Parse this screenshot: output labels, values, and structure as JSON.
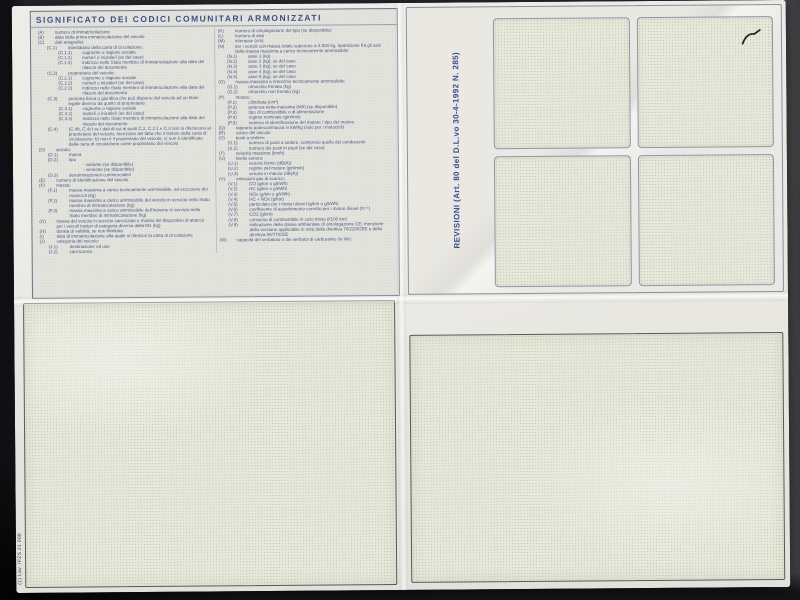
{
  "document": {
    "title": "SIGNIFICATO DEI CODICI COMUNITARI ARMONIZZATI",
    "revisions_label": "REVISIONI (Art. 80 del D.L.vo 30-4-1992 N. 285)",
    "print_code": "(1) Lav. IPZS 21 008",
    "colors": {
      "photo_background": "#232427",
      "paper": "#e8e7e2",
      "ink_blue": "#4a557e",
      "box_fill": "#e6e8db",
      "box_dot": "#7d915f",
      "border_gray": "#8a8f9c",
      "border_dark": "#565b52"
    },
    "codes_left": [
      {
        "c": "(A)",
        "t": "numero di immatricolazione",
        "lvl": 0
      },
      {
        "c": "(B)",
        "t": "data della prima immatricolazione del veicolo",
        "lvl": 0
      },
      {
        "c": "(C)",
        "t": "dati anagrafici:",
        "lvl": 0
      },
      {
        "c": "(C.1)",
        "t": "intestatario della carta di circolazione:",
        "lvl": 1
      },
      {
        "c": "(C.1.1)",
        "t": "cognome o ragione sociale",
        "lvl": 2
      },
      {
        "c": "(C.1.2)",
        "t": "nome/i o iniziale/i (se del caso)",
        "lvl": 2
      },
      {
        "c": "(C.1.3)",
        "t": "indirizzo nello Stato membro di immatricolazione alla data del rilascio del documento",
        "lvl": 2
      },
      {
        "c": "(C.2)",
        "t": "proprietario del veicolo:",
        "lvl": 1
      },
      {
        "c": "(C.2.1)",
        "t": "cognome o ragione sociale",
        "lvl": 2
      },
      {
        "c": "(C.2.2)",
        "t": "nome/i o iniziale/i (se del caso)",
        "lvl": 2
      },
      {
        "c": "(C.2.3)",
        "t": "indirizzo nello Stato membro di immatricolazione alla data del rilascio del documento",
        "lvl": 2
      },
      {
        "c": "(C.3)",
        "t": "persona fisica o giuridica che può disporre del veicolo ad un titolo legale diverso da quello di proprietario:",
        "lvl": 1
      },
      {
        "c": "(C.3.1)",
        "t": "cognome o ragione sociale",
        "lvl": 2
      },
      {
        "c": "(C.3.2)",
        "t": "nome/i o iniziale/i (se del caso)",
        "lvl": 2
      },
      {
        "c": "(C.3.3)",
        "t": "indirizzo nello Stato membro di immatricolazione alla data del rilascio del documento",
        "lvl": 2
      },
      {
        "c": "(C.4)",
        "t": "(C.4b, C.4c) se i dati di cui ai punti C.2, C.2.1 e C.3 non si riferiscono al proprietario del veicolo, menzione del fatto che il titolare della carta di circolazione: b) non è il proprietario del veicolo; c) non è identificato dalla carta di circolazione come proprietario del veicolo",
        "lvl": 1
      },
      {
        "c": "(D)",
        "t": "veicolo:",
        "lvl": 0
      },
      {
        "c": "(D.1)",
        "t": "marca",
        "lvl": 1
      },
      {
        "c": "(D.2)",
        "t": "tipo",
        "lvl": 1
      },
      {
        "c": "",
        "t": "- variante (se disponibile)",
        "lvl": 2
      },
      {
        "c": "",
        "t": "- versione (se disponibile)",
        "lvl": 2
      },
      {
        "c": "(D.3)",
        "t": "denominazione/i commerciale/i",
        "lvl": 1
      },
      {
        "c": "(E)",
        "t": "numero di identificazione del veicolo",
        "lvl": 0
      },
      {
        "c": "(F)",
        "t": "massa:",
        "lvl": 0
      },
      {
        "c": "(F.1)",
        "t": "massa massima a carico tecnicamente ammissibile, ad eccezione dei motocicli (kg)",
        "lvl": 1
      },
      {
        "c": "(F.2)",
        "t": "massa massima a carico ammissibile del veicolo in servizio nello Stato membro di immatricolazione (kg)",
        "lvl": 1
      },
      {
        "c": "(F.3)",
        "t": "massa massima a carico ammissibile dell'insieme in servizio nello Stato membro di immatricolazione (kg)",
        "lvl": 1
      },
      {
        "c": "(G)",
        "t": "massa del veicolo in servizio carrozzato e munito del dispositivo di attacco per i veicoli trattori di categoria diversa dalla M1 (kg)",
        "lvl": 0
      },
      {
        "c": "(H)",
        "t": "durata di validità, se non illimitata",
        "lvl": 0
      },
      {
        "c": "(I)",
        "t": "data di immatricolazione alla quale si riferisce la carta di circolazione",
        "lvl": 0
      },
      {
        "c": "(J)",
        "t": "categoria del veicolo:",
        "lvl": 0
      },
      {
        "c": "(J.1)",
        "t": "destinazione ed uso",
        "lvl": 1
      },
      {
        "c": "(J.2)",
        "t": "carrozzeria",
        "lvl": 1
      }
    ],
    "codes_right": [
      {
        "c": "(K)",
        "t": "numero di omologazione del tipo (se disponibile)",
        "lvl": 0
      },
      {
        "c": "(L)",
        "t": "numero di assi",
        "lvl": 0
      },
      {
        "c": "(M)",
        "t": "interasse (cm)",
        "lvl": 0
      },
      {
        "c": "(N)",
        "t": "per i veicoli con massa totale superiore a 3.500 kg, ripartizione fra gli assi della massa massima a carico tecnicamente ammissibile:",
        "lvl": 0
      },
      {
        "c": "(N.1)",
        "t": "asse 1 (kg)",
        "lvl": 1
      },
      {
        "c": "(N.2)",
        "t": "asse 2 (kg), se del caso",
        "lvl": 1
      },
      {
        "c": "(N.3)",
        "t": "asse 3 (kg), se del caso",
        "lvl": 1
      },
      {
        "c": "(N.4)",
        "t": "asse 4 (kg), se del caso",
        "lvl": 1
      },
      {
        "c": "(N.5)",
        "t": "asse 5 (kg), se del caso",
        "lvl": 1
      },
      {
        "c": "(O)",
        "t": "massa massima a rimorchio tecnicamente ammissibile:",
        "lvl": 0
      },
      {
        "c": "(O.1)",
        "t": "rimorchio frenato (kg)",
        "lvl": 1
      },
      {
        "c": "(O.2)",
        "t": "rimorchio non frenato (kg)",
        "lvl": 1
      },
      {
        "c": "(P)",
        "t": "motore:",
        "lvl": 0
      },
      {
        "c": "(P.1)",
        "t": "cilindrata (cm³)",
        "lvl": 1
      },
      {
        "c": "(P.2)",
        "t": "potenza netta massima (kW) (se disponibile)",
        "lvl": 1
      },
      {
        "c": "(P.3)",
        "t": "tipo di combustibile o di alimentazione",
        "lvl": 1
      },
      {
        "c": "(P.4)",
        "t": "regime nominale (giri/min)",
        "lvl": 1
      },
      {
        "c": "(P.5)",
        "t": "numero di identificazione del motore / tipo del motore",
        "lvl": 1
      },
      {
        "c": "(Q)",
        "t": "rapporto potenza/massa in kW/kg (solo per i motocicli)",
        "lvl": 0
      },
      {
        "c": "(R)",
        "t": "colore del veicolo",
        "lvl": 0
      },
      {
        "c": "(S)",
        "t": "posti a sedere:",
        "lvl": 0
      },
      {
        "c": "(S.1)",
        "t": "numero di posti a sedere, compreso quello del conducente",
        "lvl": 1
      },
      {
        "c": "(S.2)",
        "t": "numero dei posti in piedi (se del caso)",
        "lvl": 1
      },
      {
        "c": "(T)",
        "t": "velocità massima (km/h)",
        "lvl": 0
      },
      {
        "c": "(U)",
        "t": "livello sonoro:",
        "lvl": 0
      },
      {
        "c": "(U.1)",
        "t": "veicolo fermo (dB(A))",
        "lvl": 1
      },
      {
        "c": "(U.2)",
        "t": "regime del motore (giri/min)",
        "lvl": 1
      },
      {
        "c": "(U.3)",
        "t": "veicolo in marcia (dB(A))",
        "lvl": 1
      },
      {
        "c": "(V)",
        "t": "emissioni gas di scarico:",
        "lvl": 0
      },
      {
        "c": "(V.1)",
        "t": "CO (g/km o g/kWh)",
        "lvl": 1
      },
      {
        "c": "(V.2)",
        "t": "HC (g/km o g/kWh)",
        "lvl": 1
      },
      {
        "c": "(V.3)",
        "t": "NOx (g/km o g/kWh)",
        "lvl": 1
      },
      {
        "c": "(V.4)",
        "t": "HC + NOx (g/km)",
        "lvl": 1
      },
      {
        "c": "(V.5)",
        "t": "particolato per i motori diesel (g/km o g/kWh)",
        "lvl": 1
      },
      {
        "c": "(V.6)",
        "t": "coefficiente di assorbimento corretto per i motori diesel (m⁻¹)",
        "lvl": 1
      },
      {
        "c": "(V.7)",
        "t": "CO2 (g/km)",
        "lvl": 1
      },
      {
        "c": "(V.8)",
        "t": "consumo di combustibile in ciclo misto (l/100 km)",
        "lvl": 1
      },
      {
        "c": "(V.9)",
        "t": "indicazione della classe ambientale di omologazione CE; menzione della versione applicabile in virtù della direttiva 70/220/CEE o della direttiva 88/77/CEE",
        "lvl": 1
      },
      {
        "c": "(W)",
        "t": "capacità del serbatoio o dei serbatoi di carburante (in litri)",
        "lvl": 0
      }
    ]
  }
}
